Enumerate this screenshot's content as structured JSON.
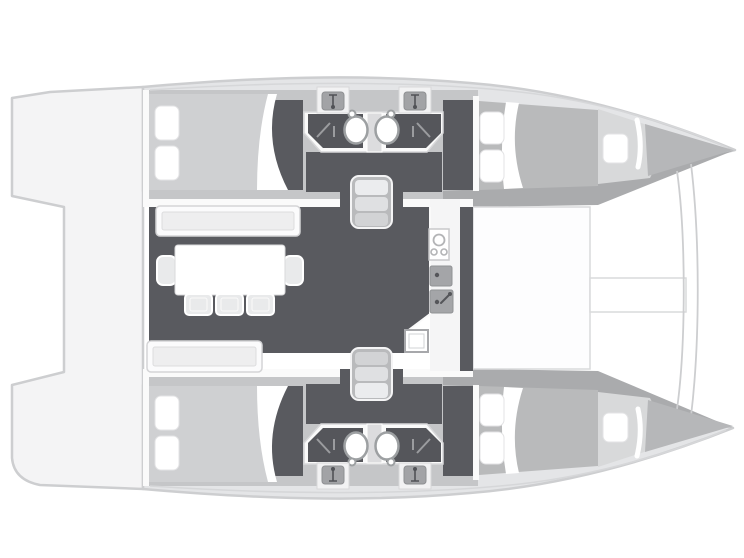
{
  "document": {
    "type": "floor-plan",
    "subject": "catamaran sailing yacht interior layout, overhead plan view",
    "orientation": {
      "bow": "right",
      "stern": "left",
      "top_hull": "port",
      "bottom_hull": "starboard"
    }
  },
  "colors": {
    "background": "#ffffff",
    "outline": "#cdced0",
    "deck": "#f4f4f5",
    "hull_light": "#e4e5e7",
    "hull_medium": "#c5c6c8",
    "hull_shadow": "#aaabad",
    "floor_dark": "#595a5f",
    "floor_darker": "#55565b",
    "wall_white": "#fafafa",
    "bed_light": "#cfd0d2",
    "bed_medium": "#b9babb",
    "berth_light": "#d8d9da",
    "bench_inner": "#eeeeef",
    "furniture_white": "#ffffff",
    "chair_fill": "#e9eaeb",
    "fixture_gray": "#a4a5a8",
    "fixture_dark": "#55565a",
    "stair_fill": "#b9babc",
    "tread_1": "#ebecee",
    "tread_2": "#dfe0e2",
    "tread_3": "#d2d3d5",
    "threshold": "#dcdcde",
    "toilet_gray": "#a2a3a6",
    "stroke_light": "#d6d7d9",
    "counter_white": "#f5f5f6"
  },
  "floorplan": {
    "decks": [
      "aft-cockpit-platform",
      "foredeck",
      "trampoline",
      "bowsprit-beam"
    ],
    "salon": {
      "furniture": [
        "sofa-bench-port",
        "sofa-bench-starboard",
        "dining-table",
        "chair",
        "chair",
        "chair",
        "end-seat",
        "end-seat"
      ],
      "galley_fixtures": [
        "three-burner-cooktop",
        "sink-basin",
        "sink-basin-with-faucet",
        "front-opening-appliance"
      ]
    },
    "hulls": [
      {
        "id": "port-hull",
        "position": "top",
        "rooms": [
          "aft-double-cabin",
          "aft-bathroom",
          "companionway-stairs",
          "forward-bathroom",
          "forward-double-cabin",
          "forepeak-berth"
        ]
      },
      {
        "id": "starboard-hull",
        "position": "bottom",
        "rooms": [
          "aft-double-cabin",
          "aft-bathroom",
          "companionway-stairs",
          "forward-bathroom",
          "forward-double-cabin",
          "forepeak-berth"
        ]
      }
    ],
    "fixture_counts": {
      "double_berths": 4,
      "single_berths": 2,
      "pillows": 10,
      "washbasins": 4,
      "toilets": 4,
      "showers": 4,
      "stair_flights": 2,
      "cooktop_burners": 3
    }
  }
}
